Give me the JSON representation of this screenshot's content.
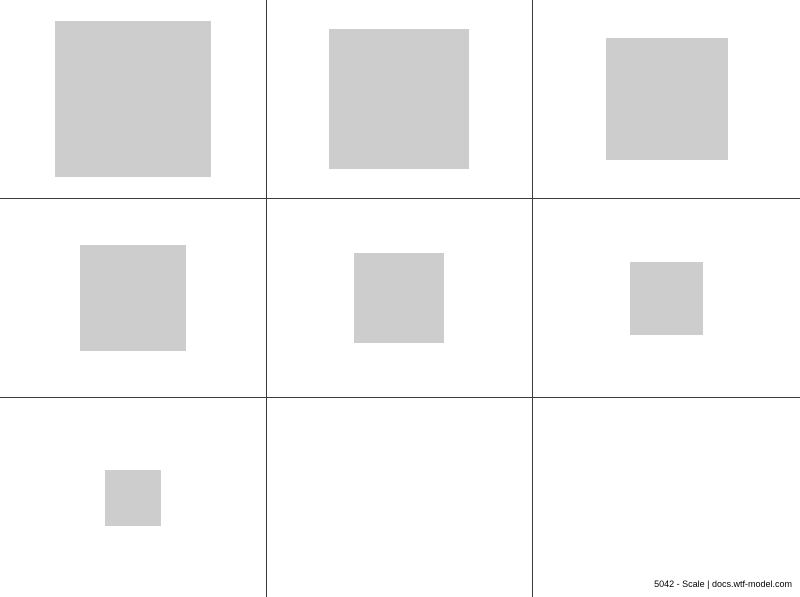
{
  "page": {
    "background_color": "#ffffff",
    "width_px": 800,
    "height_px": 597
  },
  "grid": {
    "rows": 3,
    "cols": 3,
    "line_color": "#3c3c3c",
    "line_width_px": 1,
    "vertical_lines_x_px": [
      267,
      533
    ],
    "horizontal_lines_y_px": [
      199,
      398
    ]
  },
  "squares": {
    "fill_color": "#cdcdcd",
    "count": 7,
    "cells": [
      {
        "row": 0,
        "col": 0,
        "size_px": 156
      },
      {
        "row": 0,
        "col": 1,
        "size_px": 140
      },
      {
        "row": 0,
        "col": 2,
        "size_px": 122
      },
      {
        "row": 1,
        "col": 0,
        "size_px": 106
      },
      {
        "row": 1,
        "col": 1,
        "size_px": 90
      },
      {
        "row": 1,
        "col": 2,
        "size_px": 73
      },
      {
        "row": 2,
        "col": 0,
        "size_px": 56
      }
    ],
    "empty_cells": [
      {
        "row": 2,
        "col": 1
      },
      {
        "row": 2,
        "col": 2
      }
    ]
  },
  "footer": {
    "label": "5042 - Scale | docs.wtf-model.com",
    "color": "#000000"
  }
}
